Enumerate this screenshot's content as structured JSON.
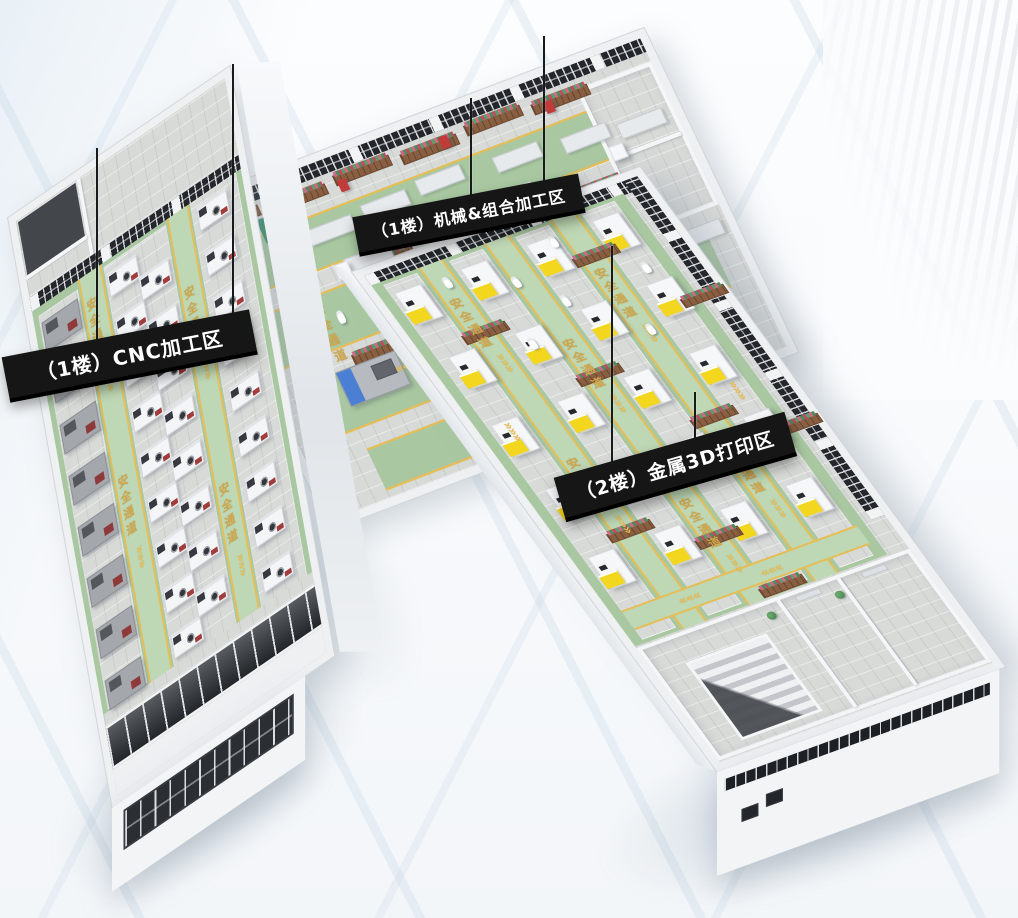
{
  "areas": [
    {
      "id": "cnc-machining",
      "banner_label": "（1楼）CNC加工区"
    },
    {
      "id": "mechanical-combined-machining",
      "banner_label": "（1楼）机械&组合加工区"
    },
    {
      "id": "metal-3d-printing",
      "banner_label": "（2楼）金属3D打印区"
    }
  ],
  "floor_markings": {
    "safety_text": "安全通道",
    "chevron_glyph": "«"
  },
  "colors": {
    "floor_green": "#a9c8a1",
    "aisle_green": "#bed7b4",
    "path_yellow": "#e7bd54",
    "marking_text": "#cfa64c",
    "banner_bg": "#161616",
    "banner_text": "#ffffff",
    "wall_white": "#f2f4f6",
    "concrete": "#d8dad8",
    "glass_dark": "#282c31",
    "printer_yellow": "#f2d71e",
    "machine_gray": "#b4b8bc",
    "accent_blue": "#4a7fd4",
    "robot_green": "#3f9471",
    "machine_red": "#a03c3c",
    "planter_brown": "#8a5f41"
  }
}
